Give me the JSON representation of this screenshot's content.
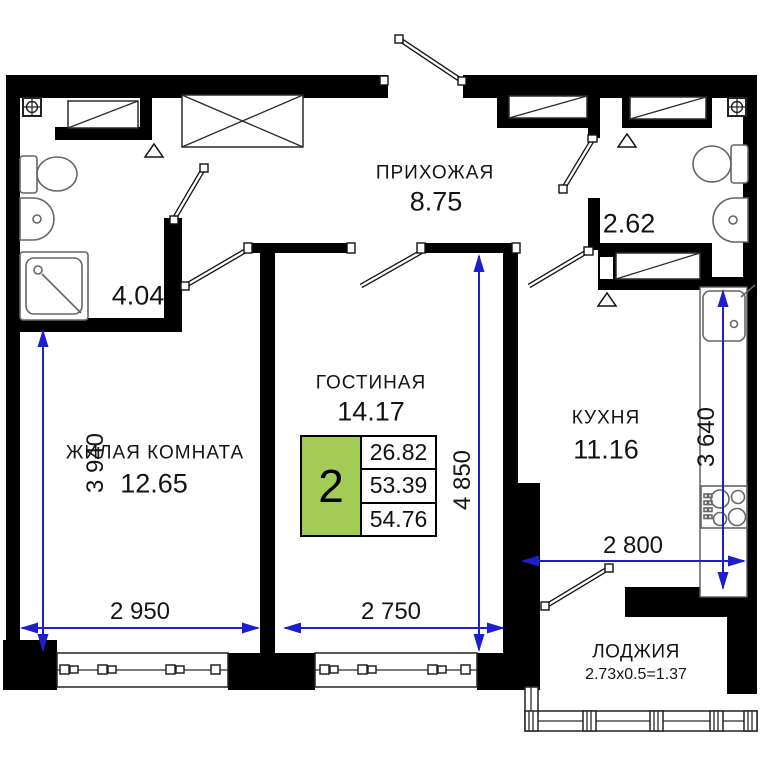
{
  "plan": {
    "rooms": {
      "hallway": {
        "name": "ПРИХОЖАЯ",
        "area": "8.75"
      },
      "bathroom": {
        "area": "4.04"
      },
      "wc": {
        "area": "2.62"
      },
      "living_room": {
        "name": "ЖИЛАЯ КОМНАТА",
        "area": "12.65"
      },
      "lounge": {
        "name": "ГОСТИНАЯ",
        "area": "14.17"
      },
      "kitchen": {
        "name": "КУХНЯ",
        "area": "11.16"
      },
      "loggia": {
        "name": "ЛОДЖИЯ",
        "area_formula": "2.73x0.5=1.37"
      }
    },
    "summary_box": {
      "rooms_count": "2",
      "values": [
        "26.82",
        "53.39",
        "54.76"
      ]
    },
    "dimensions": {
      "living_width": "2 950",
      "living_depth": "3 940",
      "lounge_width": "2 750",
      "lounge_depth": "4 850",
      "kitchen_width": "2 800",
      "kitchen_depth": "3 640"
    },
    "colors": {
      "wall": "#000000",
      "dimension_blue": "#1e1ecf",
      "summary_green": "#a3cc57"
    },
    "icons": [
      "vent-icon",
      "toilet-icon",
      "washbasin-icon",
      "shower-icon",
      "wardrobe-icon",
      "closet-icon",
      "kitchen-sink-icon",
      "stove-icon",
      "window",
      "door-swing",
      "loggia-glazing"
    ]
  }
}
